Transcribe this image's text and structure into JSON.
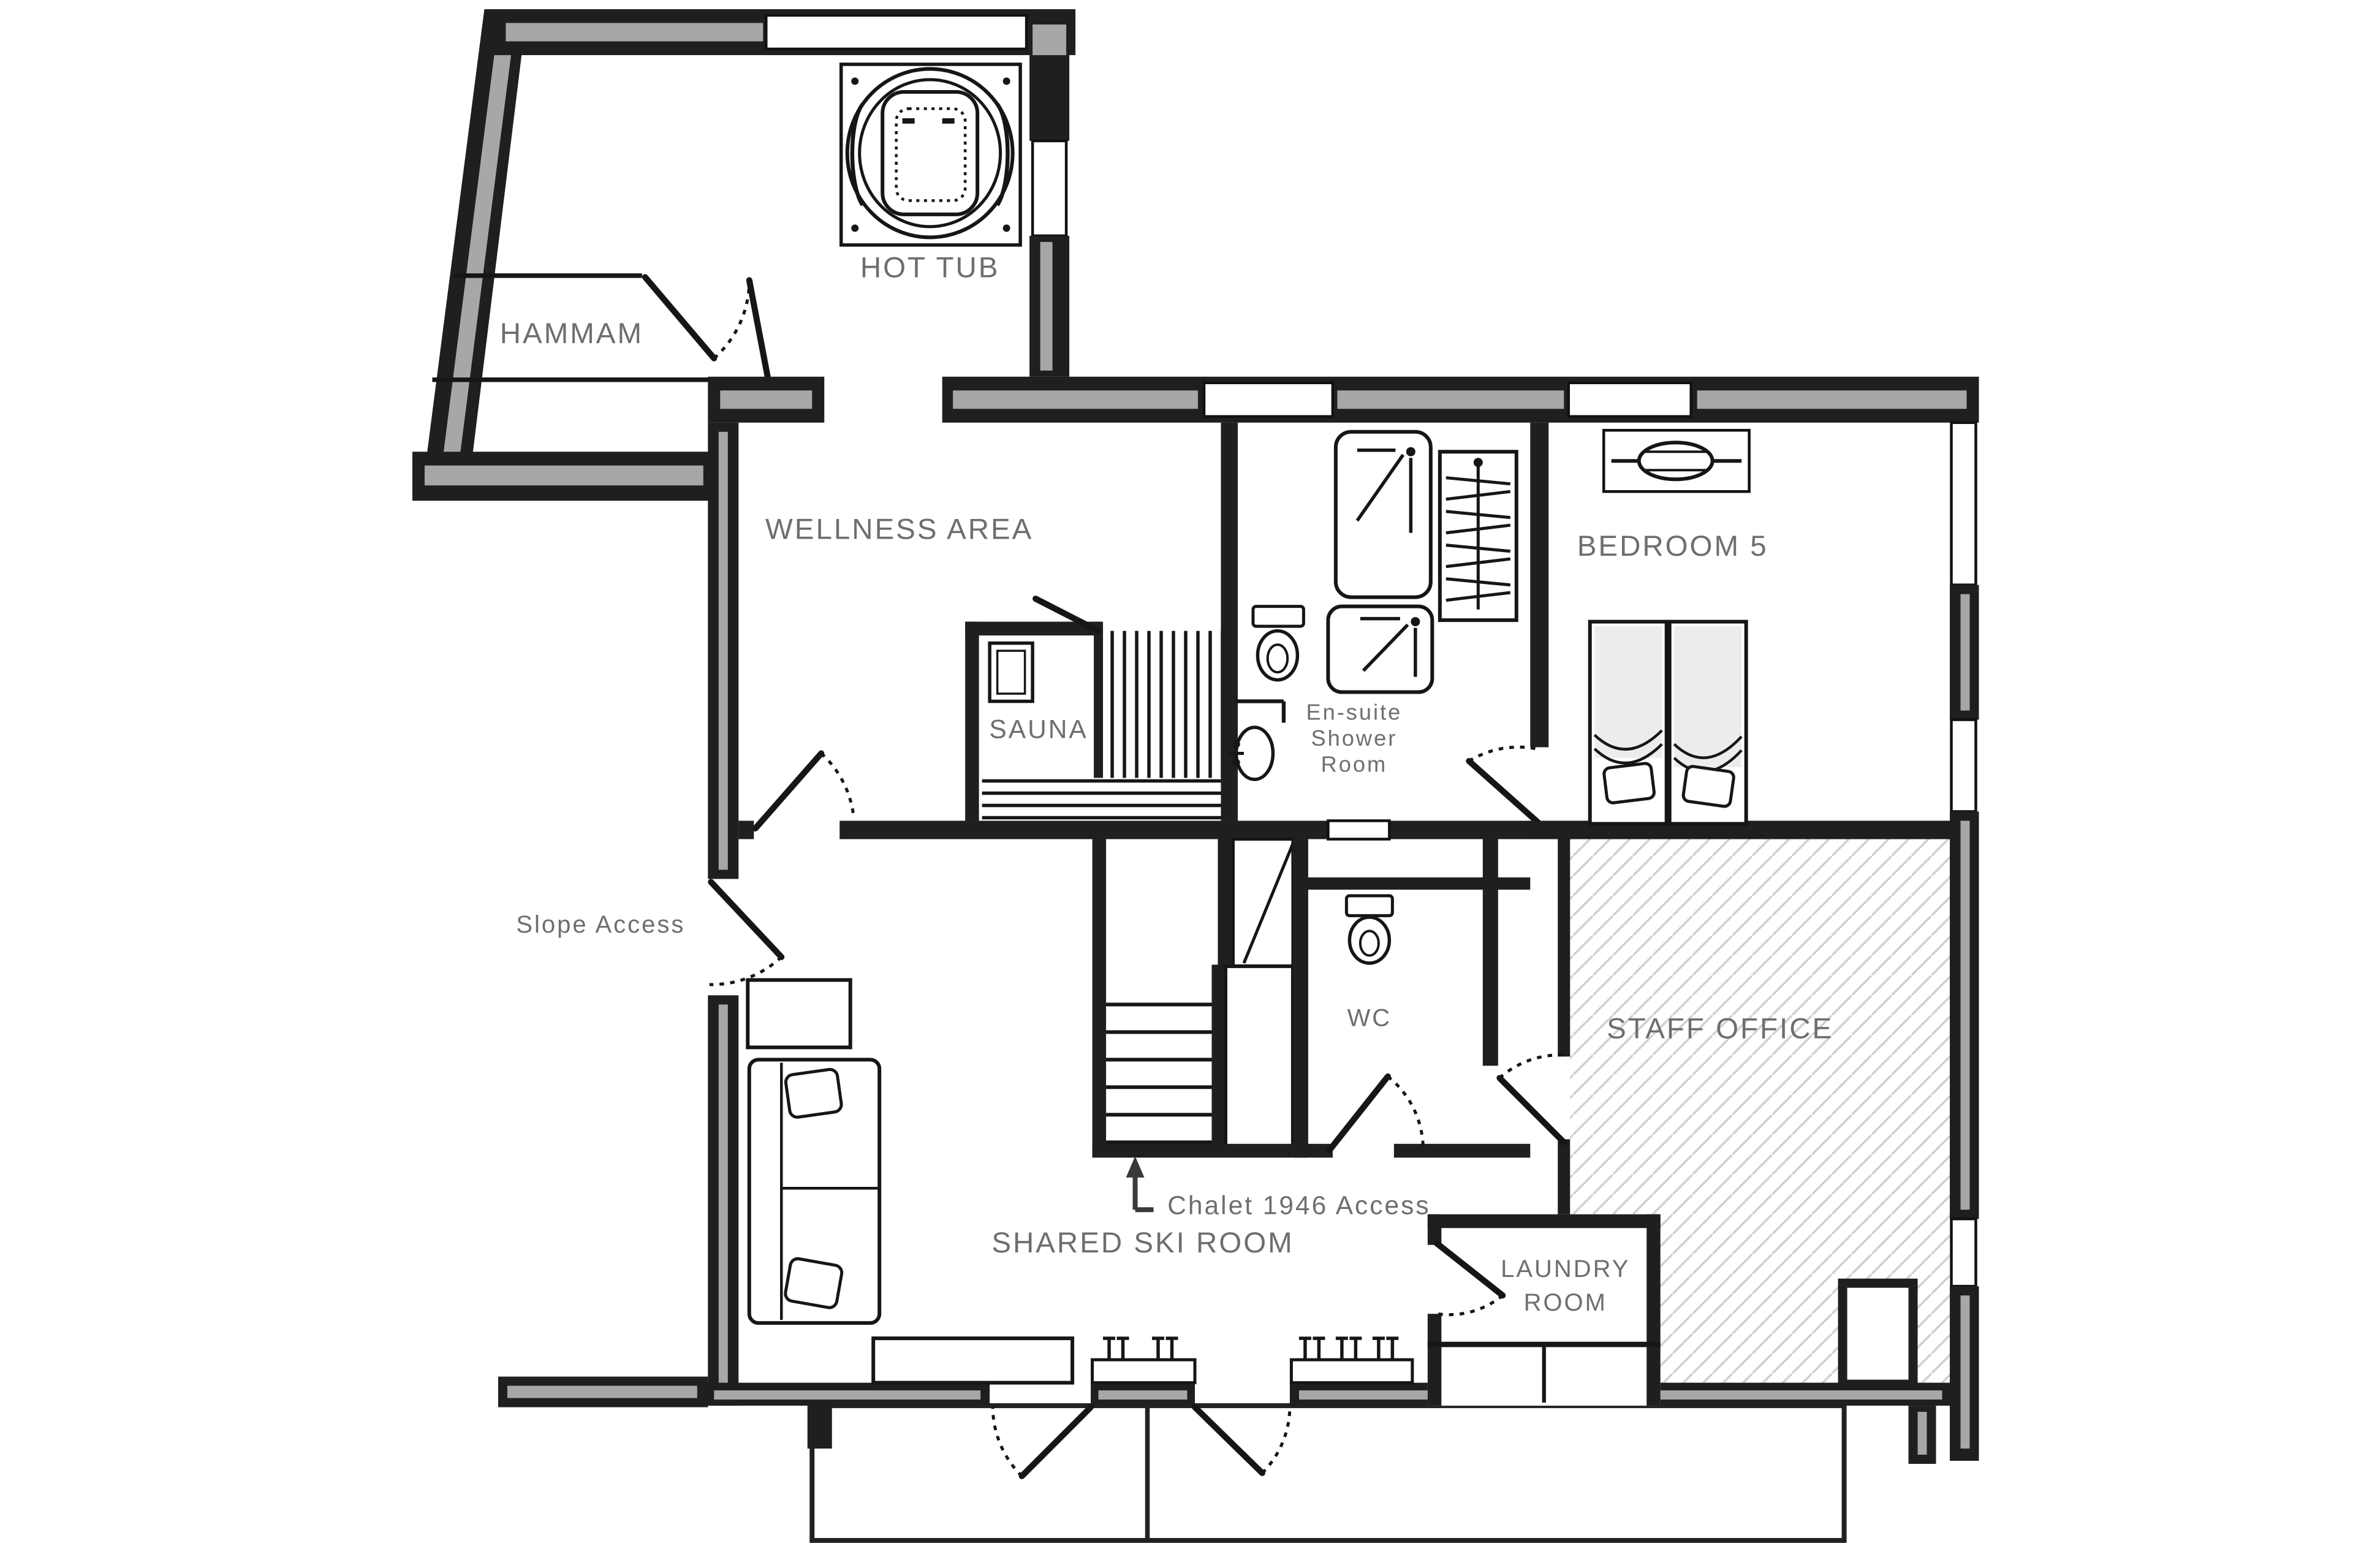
{
  "floorplan": {
    "background": "#ffffff",
    "colors": {
      "wall": "#1f1f1f",
      "wall_core": "#a7a7a7",
      "line": "#161616",
      "label": "#6e6e6e",
      "hatch": "#cfcfcf",
      "duvet": "#ececec"
    },
    "rooms": {
      "hot_tub": "HOT TUB",
      "hammam": "HAMMAM",
      "wellness_area": "WELLNESS AREA",
      "sauna": "SAUNA",
      "ensuite": {
        "line1": "En-suite",
        "line2": "Shower",
        "line3": "Room"
      },
      "bedroom5": "BEDROOM 5",
      "wc": "WC",
      "staff_office": "STAFF OFFICE",
      "shared_ski_room": "SHARED SKI ROOM",
      "laundry": {
        "line1": "LAUNDRY",
        "line2": "ROOM"
      }
    },
    "annotations": {
      "slope_access": "Slope Access",
      "chalet_access": "Chalet 1946 Access"
    }
  }
}
